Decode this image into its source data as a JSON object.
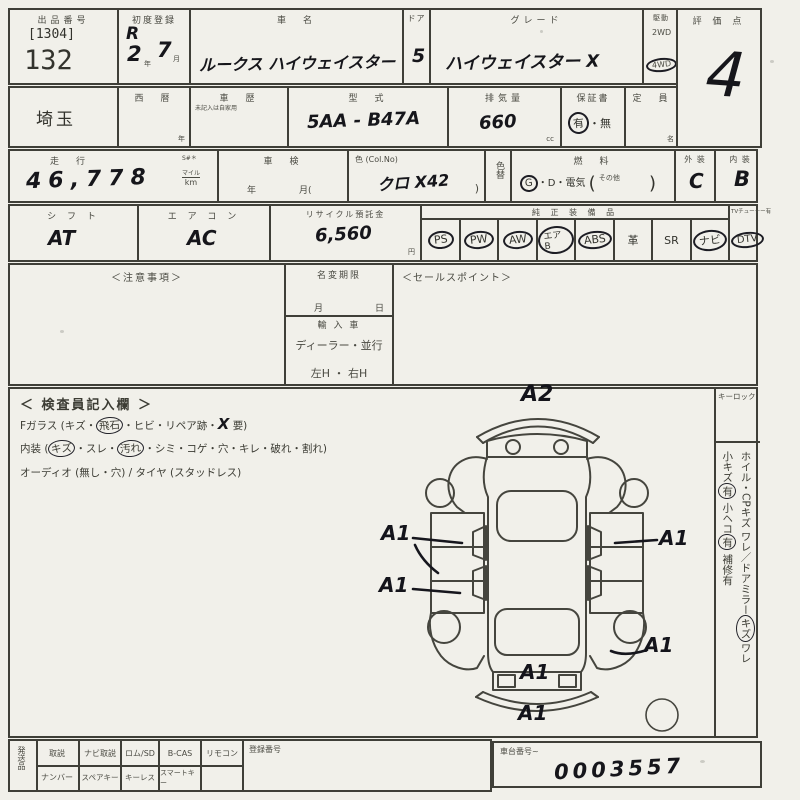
{
  "row1": {
    "lot_label": "出品番号",
    "lot_bracket": "[1304]",
    "lot_number": "132",
    "firstreg_label": "初度登録",
    "firstreg_era": "R",
    "firstreg_year": "2",
    "year_unit": "年",
    "firstreg_month": "7",
    "month_unit": "月",
    "carname_label": "車　名",
    "carname_value": "ルークス ハイウェイスター",
    "door_label": "ドア",
    "door_value": "5",
    "grade_label": "グレード",
    "grade_value": "ハイウェイスター X",
    "drive_label": "駆動",
    "drive_2wd": "2WD",
    "drive_4wd": "4WD",
    "score_label": "評 価 点",
    "score_value": "4"
  },
  "row2": {
    "prefecture": "埼玉",
    "seireki_label": "西　暦",
    "seireki_unit": "年",
    "history_label": "車　歴",
    "history_note": "未記入は自家用",
    "model_label": "型　式",
    "model_value": "5AA - B47A",
    "disp_label": "排気量",
    "disp_value": "660",
    "disp_unit": "cc",
    "warranty_label": "保証書",
    "warranty_yes": "有",
    "warranty_dot": "・",
    "warranty_no": "無",
    "capacity_label": "定　員",
    "capacity_unit": "名"
  },
  "row3": {
    "mileage_label": "走　行",
    "mileage_s": "S#＊",
    "mileage_value": "46,778",
    "mileage_unit_top": "マイル",
    "mileage_unit": "km",
    "shaken_label": "車　検",
    "shaken_year": "年",
    "shaken_month": "月(",
    "color_label": "色 (Col.No)",
    "color_value": "クロ X42",
    "color_close": ")",
    "colorchange_label": "色替",
    "fuel_label": "燃　料",
    "fuel_g": "G",
    "fuel_rest": "・D・電気",
    "fuel_open": "(",
    "fuel_other": "その他",
    "fuel_close": ")",
    "exterior_label": "外 装",
    "exterior_value": "C",
    "interior_label": "内 装",
    "interior_value": "B"
  },
  "row4": {
    "shift_label": "シ フ ト",
    "shift_value": "AT",
    "aircon_label": "エ ア コ ン",
    "aircon_value": "AC",
    "recycle_label": "リサイクル預託金",
    "recycle_value": "6,560",
    "recycle_unit": "円",
    "equip_label": "純 正 装 備 品",
    "tv_label": "TVチューナー有",
    "equip_items": [
      {
        "name": "PS",
        "circled": true
      },
      {
        "name": "PW",
        "circled": true
      },
      {
        "name": "AW",
        "circled": true
      },
      {
        "name": "エアB",
        "circled": true
      },
      {
        "name": "ABS",
        "circled": true
      },
      {
        "name": "革",
        "circled": false
      },
      {
        "name": "SR",
        "circled": false
      },
      {
        "name": "ナビ",
        "circled": true
      }
    ],
    "tv_item": {
      "name": "DTV",
      "circled": true
    }
  },
  "row5": {
    "notes_label": "＜注意事項＞",
    "namechange_label": "名変期限",
    "namechange_month": "月",
    "namechange_day": "日",
    "import_label": "輸 入 車",
    "import_dealer": "ディーラー・並行",
    "import_handle": "左H ・ 右H",
    "sales_label": "＜セールスポイント＞"
  },
  "inspector": {
    "title": "＜ 検査員記入欄 ＞",
    "fglass_pre": "Fガラス (キズ・",
    "fglass_circled": "飛石",
    "fglass_mid": "・ヒビ・リペア跡・",
    "fglass_hand": "X",
    "fglass_tail": "要)",
    "interior_pre": "内装 (",
    "interior_c1": "キズ",
    "interior_m1": "・スレ・",
    "interior_c2": "汚れ",
    "interior_tail": "・シミ・コゲ・穴・キレ・破れ・割れ)",
    "audio_line": "オーディオ (無し・穴) / タイヤ (スタッドレス)"
  },
  "right_col": {
    "keylock": "キーロック",
    "line1_pre": "ホイル・CPキズ ワレ／ドアミラー",
    "line1_circled": "キズ",
    "line1_tail": "ワレ",
    "line2_a": "小キズ",
    "line2_a_c": "有",
    "line2_b": "小ヘコ",
    "line2_b_c": "有",
    "line2_c": "補修有"
  },
  "diagram": {
    "a2": "A2",
    "a1": "A1"
  },
  "bottom": {
    "side_label": "発送品",
    "row1": [
      "取説",
      "ナビ取説",
      "ロム/SD",
      "B-CAS",
      "リモコン"
    ],
    "row2": [
      "ナンバー",
      "スペアキー",
      "キーレス",
      "スマートキー",
      ""
    ],
    "reg_label": "登録番号",
    "chassis_label": "車台番号~",
    "chassis_value": "0003557"
  }
}
